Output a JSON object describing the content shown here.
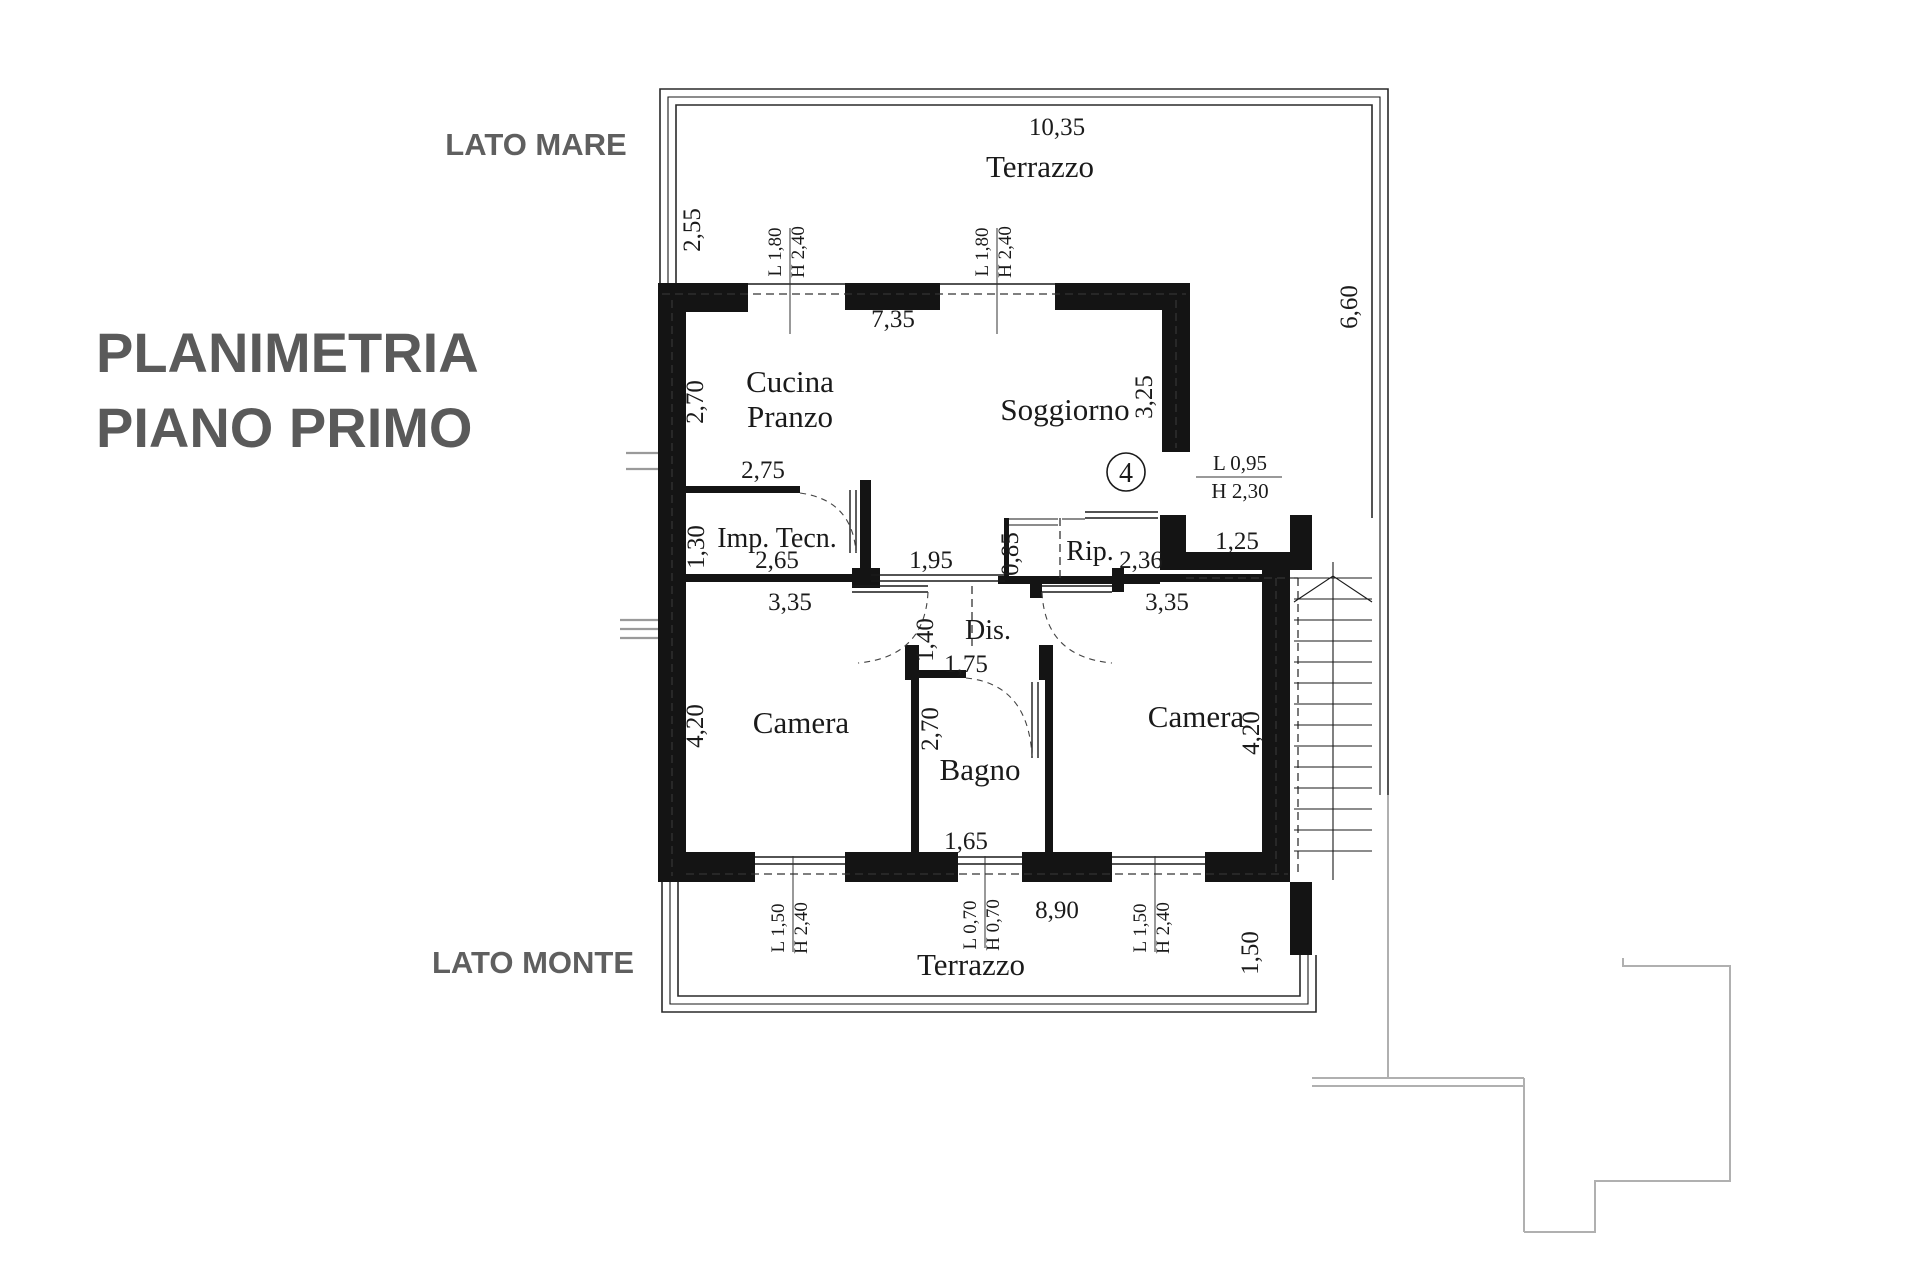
{
  "page": {
    "title_line1": "PLANIMETRIA",
    "title_line2": "PIANO PRIMO"
  },
  "orientation": {
    "top": "LATO MARE",
    "bottom": "LATO MONTE"
  },
  "rooms": {
    "terrace_top": "Terrazzo",
    "kitchen_line1": "Cucina",
    "kitchen_line2": "Pranzo",
    "living": "Soggiorno",
    "tech": "Imp. Tecn.",
    "storage": "Rip.",
    "hall": "Dis.",
    "bedroom_left": "Camera",
    "bedroom_right": "Camera",
    "bath": "Bagno",
    "terrace_bottom": "Terrazzo"
  },
  "dims": {
    "terrace_top_width": "10,35",
    "terrace_top_depth": "2,55",
    "top_wall_span": "7,35",
    "terrace_right_height": "6,60",
    "kitchen_depth": "2,70",
    "living_depth": "3,25",
    "tech_width_top": "2,75",
    "tech_depth": "1,30",
    "tech_width_bottom": "2,65",
    "corridor_opening": "1,95",
    "storage_depth": "0,85",
    "storage_width": "2,36",
    "landing_width": "1,25",
    "bedroom_left_width": "3,35",
    "bedroom_right_width": "3,35",
    "hall_door_width": "1,40",
    "bath_door_span": "1,75",
    "bath_depth": "2,70",
    "bedroom_left_depth": "4,20",
    "bedroom_right_depth": "4,20",
    "bath_width": "1,65",
    "bottom_span": "8,90",
    "terrace_bottom_depth": "1,50"
  },
  "windows": {
    "top_left": {
      "l": "L 1,80",
      "h": "H 2,40"
    },
    "top_right": {
      "l": "L 1,80",
      "h": "H 2,40"
    },
    "bottom_left": {
      "l": "L 1,50",
      "h": "H 2,40"
    },
    "bottom_center": {
      "l": "L 0,70",
      "h": "H 0,70"
    },
    "bottom_right": {
      "l": "L 1,50",
      "h": "H 2,40"
    }
  },
  "door": {
    "number": "4",
    "l": "L 0,95",
    "h": "H 2,30"
  }
}
